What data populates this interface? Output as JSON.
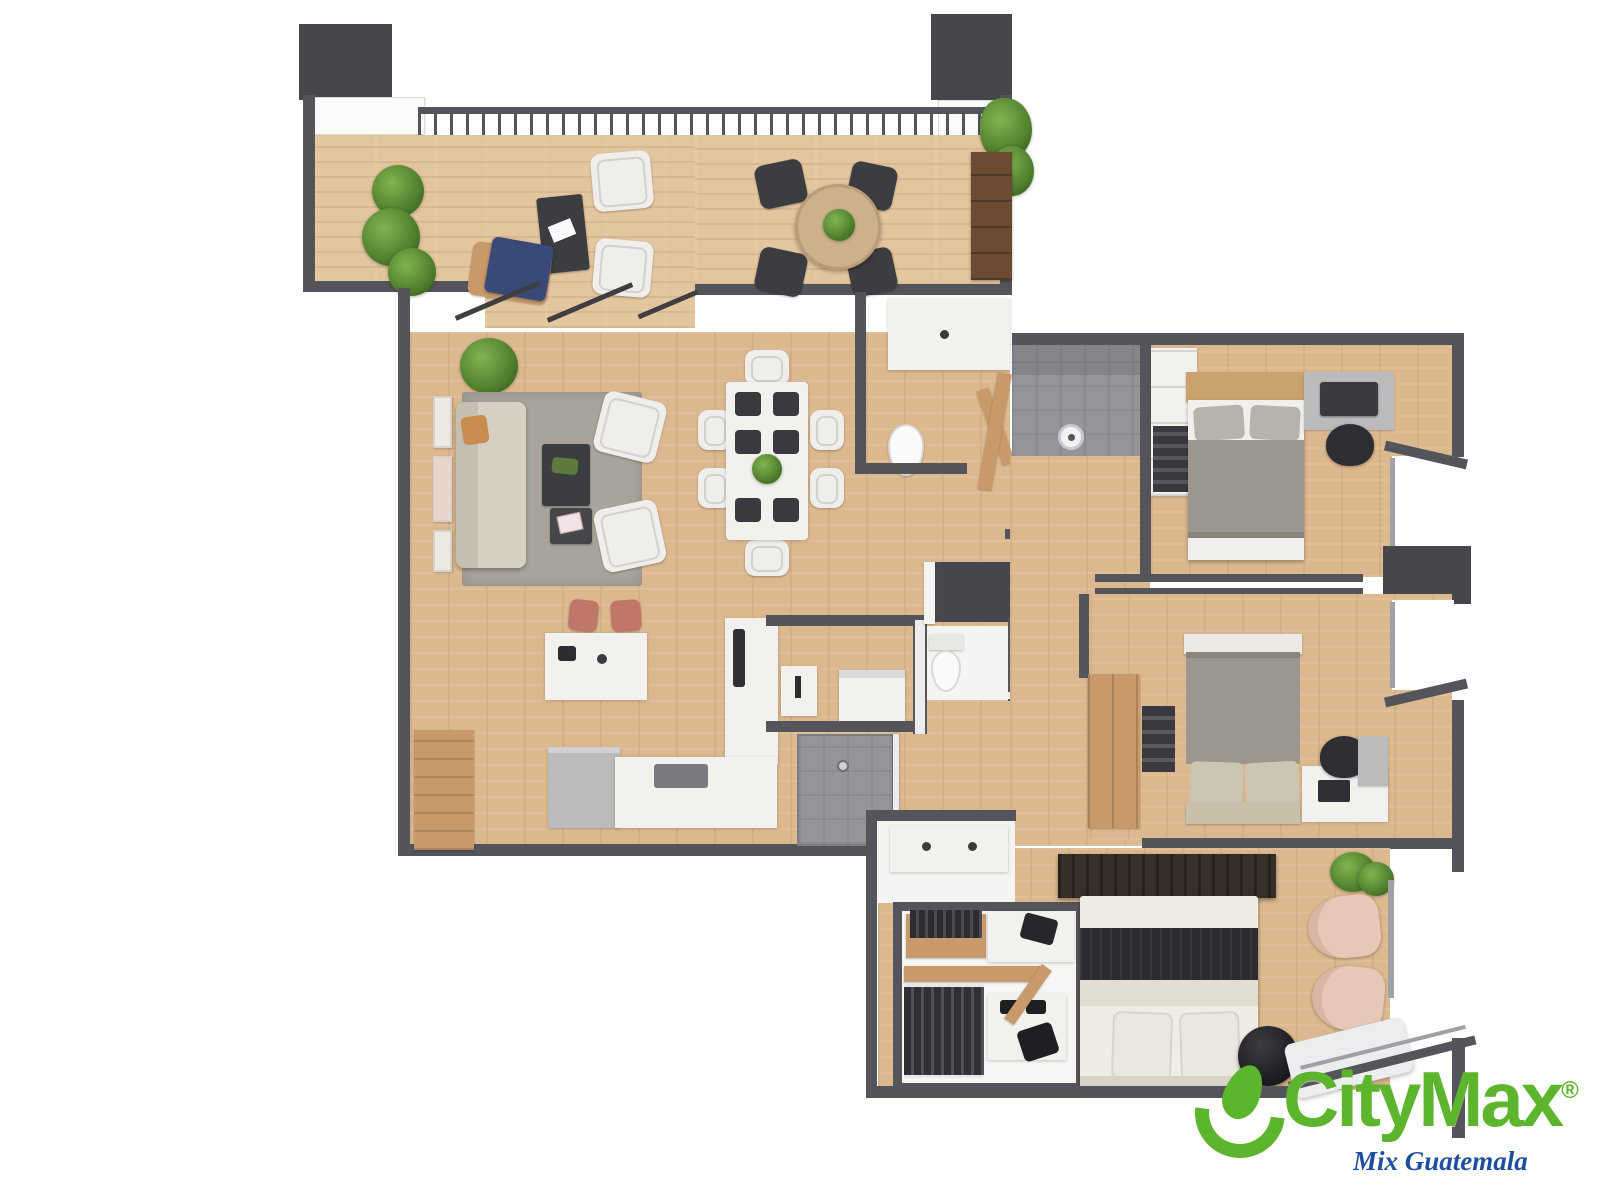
{
  "meta": {
    "kind": "3d-rendered-apartment-floor-plan",
    "orientation": "top-down",
    "visible_text_only_in_watermark": true
  },
  "brand": {
    "name": "CityMax",
    "registered": "®",
    "tagline": "Mix Guatemala"
  },
  "colors": {
    "wall": "#54555a",
    "column": "#46474b",
    "floor_wood": "#dcb88e",
    "floor_terrace": "#e3c59e",
    "white": "#f2f1ee",
    "shower_gray": "#94959a",
    "rug": "#a8a49b",
    "sofa": "#d6d0c2",
    "bed_gray": "#9c978e",
    "wood_furniture": "#c8996a",
    "dark_furniture": "#3c3d41",
    "stool_red": "#c07767",
    "lounge_blue": "#3a4a78",
    "blush": "#e7c7b7",
    "plant_dark": "#4e7d2c",
    "plant_light": "#82b551",
    "accent_green": "#5cb52d",
    "tagline_blue": "#1d4fa1"
  },
  "rooms": [
    {
      "name": "terrace",
      "furniture": [
        "railing",
        "planters",
        "outdoor-desk",
        "outdoor-chairs",
        "blue-lounge-chair",
        "round-dining-table",
        "four-dark-chairs",
        "tall-plant",
        "wood-cabinet"
      ]
    },
    {
      "name": "living-room",
      "furniture": [
        "rug",
        "sofa",
        "two-armchairs",
        "coffee-table",
        "side-table",
        "wall-frames",
        "corner-plant"
      ]
    },
    {
      "name": "dining-area",
      "furniture": [
        "dining-table",
        "six-chairs",
        "placemats",
        "centerpiece-plant"
      ]
    },
    {
      "name": "kitchen",
      "furniture": [
        "island",
        "two-red-stools",
        "sink",
        "l-shaped-counter",
        "cooktop",
        "refrigerator",
        "wood-panel"
      ]
    },
    {
      "name": "guest-bathroom",
      "furniture": [
        "vanity",
        "toilet",
        "door"
      ]
    },
    {
      "name": "shower-room",
      "furniture": [
        "shower-head",
        "wood-door"
      ]
    },
    {
      "name": "utility-room",
      "furniture": [
        "utility-sink",
        "washer"
      ]
    },
    {
      "name": "powder-room",
      "furniture": [
        "toilet",
        "dark-cabinet"
      ]
    },
    {
      "name": "second-shower",
      "furniture": [
        "glass-panel",
        "drain"
      ]
    },
    {
      "name": "bedroom-1",
      "furniture": [
        "double-bed",
        "closet",
        "desk",
        "monitor",
        "office-chair",
        "nightstand"
      ]
    },
    {
      "name": "bedroom-2",
      "furniture": [
        "double-bed",
        "wood-wardrobe",
        "shelf",
        "desk",
        "laptop",
        "office-chair",
        "nightstand"
      ]
    },
    {
      "name": "master-bathroom",
      "furniture": [
        "double-vanity"
      ]
    },
    {
      "name": "walk-in-closet",
      "furniture": [
        "hanging-clothes",
        "shelves",
        "shoe-island",
        "bags"
      ]
    },
    {
      "name": "master-bedroom",
      "furniture": [
        "king-bed",
        "dark-headboard-wall",
        "round-pouf",
        "two-blush-armchairs",
        "window-bench",
        "plant"
      ]
    },
    {
      "name": "hallway",
      "furniture": []
    }
  ]
}
